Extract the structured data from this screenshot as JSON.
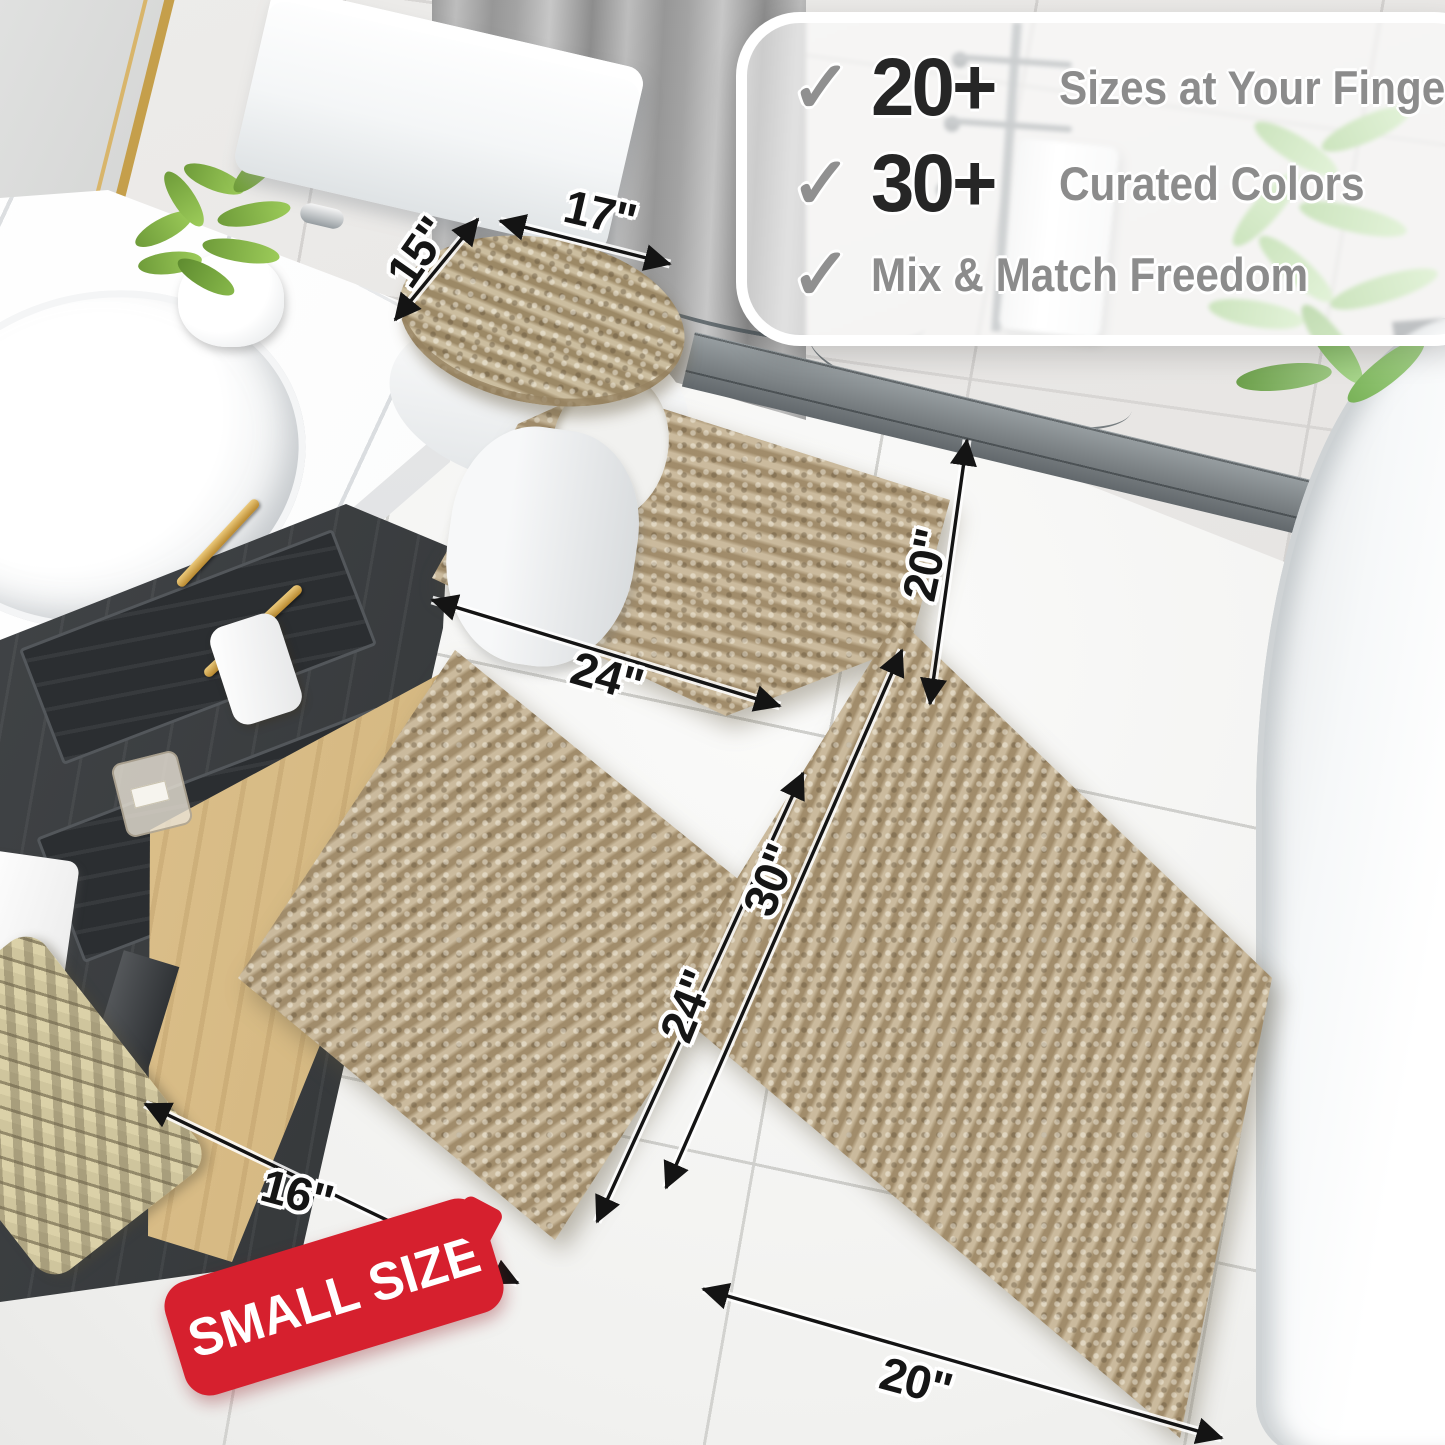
{
  "callout": {
    "check_glyph": "✓",
    "rows": [
      {
        "stat": "20+",
        "label": "Sizes at Your Fingertips"
      },
      {
        "stat": "30+",
        "label": "Curated Colors"
      },
      {
        "stat": "",
        "label": "Mix & Match Freedom"
      }
    ]
  },
  "dimensions": {
    "lid_width": "17\"",
    "lid_depth": "15\"",
    "contour_width": "24\"",
    "contour_depth": "20\"",
    "runner_length": "30\"",
    "small_length": "24\"",
    "small_width": "16\"",
    "runner_width": "20\""
  },
  "badge": {
    "label": "SMALL SIZE"
  },
  "colors": {
    "mat_beige": "#b49f7c",
    "badge_red": "#d6202e",
    "stat_dark": "#262626",
    "label_gray": "#8c8c8c",
    "check_gray": "#909090",
    "accent_gold": "#c59f4b"
  }
}
